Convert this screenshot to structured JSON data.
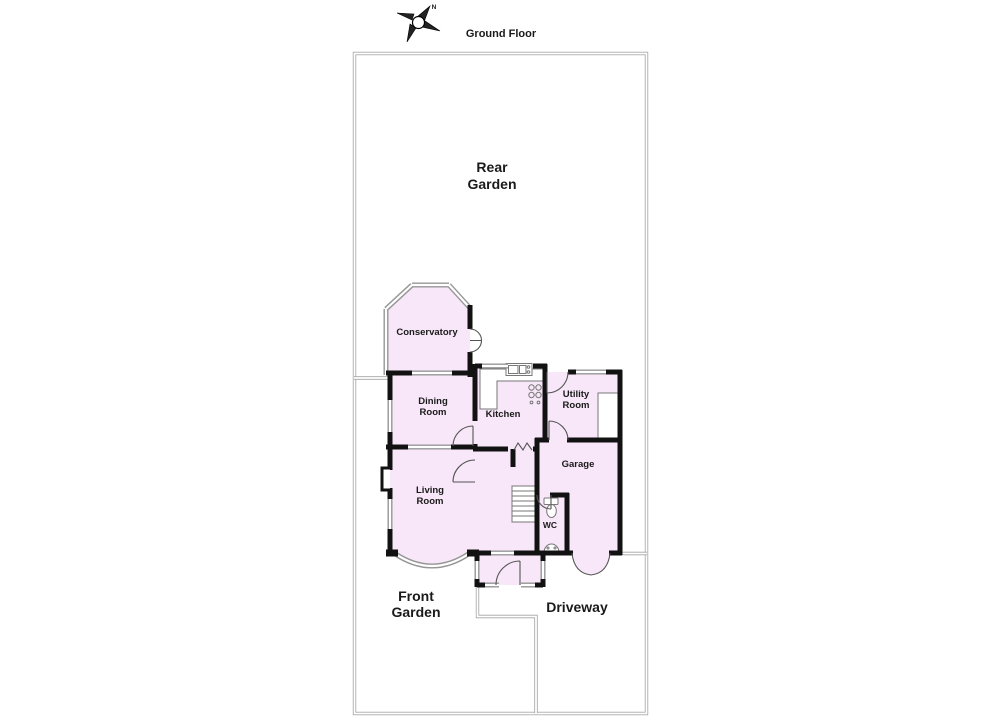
{
  "title": "Ground Floor",
  "compass": {
    "north_label": "N"
  },
  "areas": {
    "rear_garden": [
      "Rear",
      "Garden"
    ],
    "front_garden": [
      "Front",
      "Garden"
    ],
    "driveway": "Driveway"
  },
  "rooms": {
    "conservatory": "Conservatory",
    "dining_room": [
      "Dining",
      "Room"
    ],
    "kitchen": "Kitchen",
    "utility_room": [
      "Utility",
      "Room"
    ],
    "living_room": [
      "Living",
      "Room"
    ],
    "garage": "Garage",
    "wc": "WC"
  },
  "colors": {
    "room_fill": "#f8e7f8",
    "wall": "#121212",
    "window_gray": "#969696",
    "boundary_gray": "#a3a3a3",
    "text": "#1a1a1a"
  }
}
